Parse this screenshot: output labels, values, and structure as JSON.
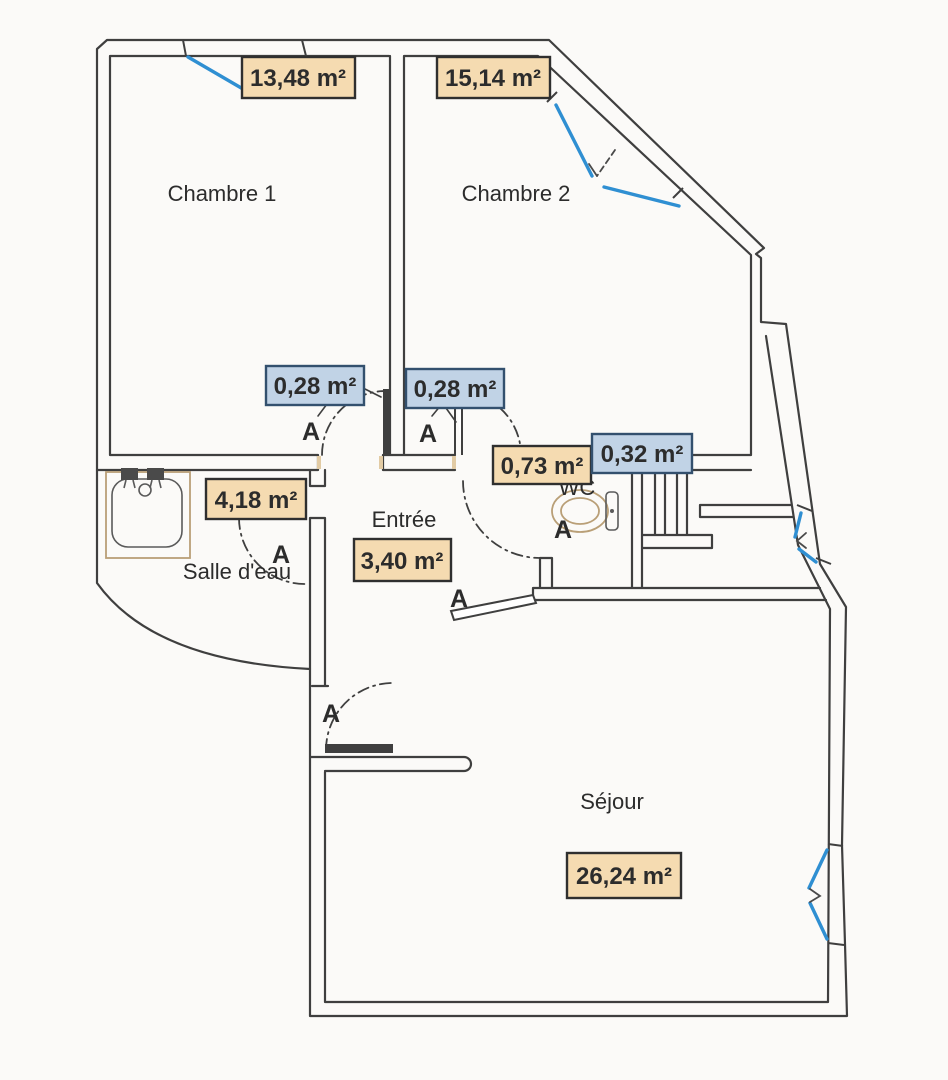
{
  "door_marker": "A",
  "rooms": [
    {
      "name": "Chambre 1",
      "area": "13,48 m²"
    },
    {
      "name": "Chambre 2",
      "area": "15,14 m²"
    },
    {
      "name": "Salle d'eau",
      "area": "4,18 m²"
    },
    {
      "name": "Entrée",
      "area": "3,40 m²"
    },
    {
      "name": "WC",
      "area": "0,73 m²"
    },
    {
      "name": "Séjour",
      "area": "26,24 m²"
    }
  ],
  "small_areas": [
    "0,28 m²",
    "0,28 m²",
    "0,32 m²"
  ],
  "colors": {
    "wall": "#3f3f3f",
    "window_blue": "#2f8fd2",
    "area_box_orange_fill": "#f5dbb1",
    "area_box_orange_border": "#2f2f2f",
    "area_box_blue_fill": "#c1d3e6",
    "area_box_blue_border": "#33506e",
    "text": "#2c2c2c",
    "fixture_tan": "#b99f77",
    "background": "#fbfaf8"
  }
}
